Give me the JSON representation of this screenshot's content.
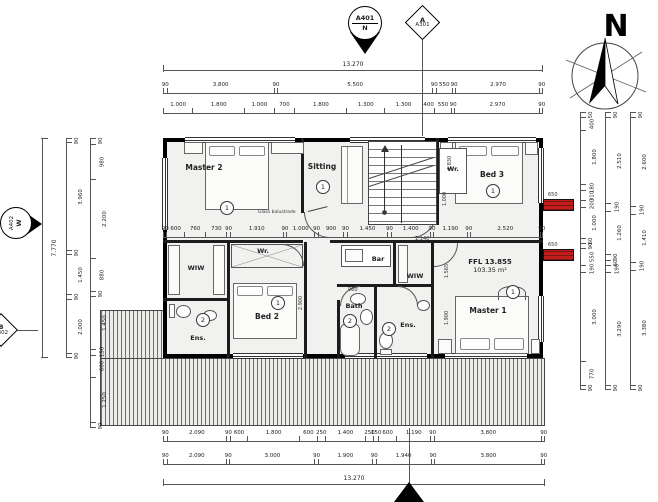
{
  "markers": {
    "section_top_code": "A401",
    "section_top_dir": "N",
    "elev_top_code": "A",
    "elev_top_sheet": "A301",
    "section_left_code": "A402",
    "section_left_dir": "W",
    "elev_left_code": "B",
    "elev_left_sheet": "A302",
    "north": "N"
  },
  "rooms": [
    {
      "name": "Master 2",
      "tag": "1"
    },
    {
      "name": "Sitting",
      "tag": "1"
    },
    {
      "name": "Bed 3",
      "tag": "1"
    },
    {
      "name": "Wr.",
      "tag": ""
    },
    {
      "name": "WIW",
      "tag": ""
    },
    {
      "name": "Wr.",
      "tag": ""
    },
    {
      "name": "Bed 2",
      "tag": "1"
    },
    {
      "name": "Ens.",
      "tag": "2"
    },
    {
      "name": "Bar",
      "tag": ""
    },
    {
      "name": "WIW",
      "tag": ""
    },
    {
      "name": "Bath",
      "tag": "2"
    },
    {
      "name": "Ens.",
      "tag": "2"
    },
    {
      "name": "Master 1",
      "tag": "1"
    }
  ],
  "annotations": {
    "glass_balustrade": "Glass balustrade",
    "ffl": "FFL 13.855",
    "area": "103.35 m²",
    "beam_650": "650"
  },
  "dimensions": {
    "overall_width": "13.270",
    "overall_width_bottom": "13.270",
    "overall_height": "7.770",
    "top_row_main": [
      "90",
      "3.800",
      "90",
      "5.500",
      "90",
      "550",
      "90",
      "2.970",
      "90"
    ],
    "top_row_detail": [
      "1.000",
      "1.800",
      "1.000",
      "700",
      "1.800",
      "1.300",
      "1.300",
      "400",
      "550",
      "90",
      "2.970",
      "90"
    ],
    "interior_row": [
      "90",
      "600",
      "760",
      "730",
      "90",
      "1.910",
      "90",
      "1.000",
      "90",
      "900",
      "90",
      "1.450",
      "90",
      "1.400",
      "90",
      "1.190",
      "90",
      "2.520",
      "90"
    ],
    "bottom_row_detail": [
      "90",
      "2.090",
      "90",
      "600",
      "1.800",
      "600",
      "250",
      "1.400",
      "250",
      "150",
      "600",
      "1.190",
      "90",
      "3.800",
      "90"
    ],
    "bottom_row_main": [
      "90",
      "2.090",
      "90",
      "3.000",
      "90",
      "1.900",
      "90",
      "1.940",
      "90",
      "3.800",
      "90"
    ],
    "left_outer": [
      "90",
      "3.960",
      "90",
      "1.450",
      "90",
      "2.000",
      "90"
    ],
    "left_inner": [
      "90",
      "980",
      "2.200",
      "880",
      "90",
      "1.450",
      "150",
      "600",
      "1.250",
      "90"
    ],
    "right_inner": [
      "50",
      "400",
      "1.800",
      "180",
      "310",
      "200",
      "1.000",
      "60",
      "90",
      "550",
      "190",
      "3.000",
      "770",
      "90"
    ],
    "right_middle": [
      "90",
      "2.510",
      "190",
      "1.260",
      "90",
      "60",
      "190",
      "3.290",
      "90"
    ],
    "right_outer": [
      "90",
      "2.600",
      "190",
      "1.410",
      "190",
      "3.380",
      "90"
    ],
    "interior_vertical": [
      "1.830",
      "1.000",
      "2.900",
      "1.565",
      "1.900",
      "1.140",
      "960"
    ]
  }
}
